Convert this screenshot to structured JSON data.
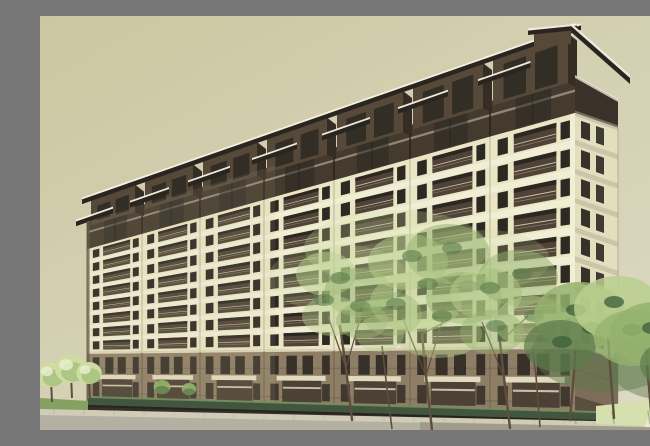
{
  "scene": {
    "type": "architectural-exterior-rendering",
    "subject": "mid-rise residential apartment building viewed in corner perspective with landscaping",
    "building": {
      "balcony_floors": 8,
      "facade_modules": 7,
      "penthouse_caps": 7,
      "podium_levels": 2
    },
    "vegetation": {
      "small_trees_left": 3,
      "transparent_trees_center": 3,
      "foreground_saplings": 2,
      "trees_right_cluster": 4
    }
  },
  "palette": {
    "sky_top": "#cbc7a1",
    "sky_bottom": "#ddd9c4",
    "cream": "#eae5c5",
    "slab_light": "#f2eed7",
    "joint": "#b3ae93",
    "corner_light": "#f4f0db",
    "balc_dark": "#4e4336",
    "balc_shadow": "#2a251f",
    "railing": "#d6d0b4",
    "win_dark": "#2c2822",
    "band_dark": "#453a2e",
    "band_rail": "#d9d4be",
    "band_mullion": "#26211b",
    "cap_front": "#57493a",
    "cap_side": "#352d24",
    "cap_roof": "#2b2520",
    "roof_fascia": "#f5f2e5",
    "side_cream": "#e3debe",
    "side_shade": "#3a3129",
    "podium": "#8f7e66",
    "podium_dark": "#4c4134",
    "podium_win": "#38312a",
    "podium_slab": "#e6dfc4",
    "podium_line": "#6b5d49",
    "podium_side": "#7d6d58",
    "hedge": "#42553f",
    "hedge_light": "#74905e",
    "hedge_base": "#241f19",
    "lawn": "#85a060",
    "grass_right": "#d5e0ae",
    "path": "#eae7d6",
    "curb": "#d0ccb8",
    "road": "#b5b1a2",
    "road_shade": "#8e8878",
    "tree_pale": "#cddd9f",
    "tree_light": "#b9cf8e",
    "tree_mid": "#94b26d",
    "tree_dark": "#5c7b4b",
    "tree_deep": "#3e5d39",
    "trunk": "#5d4e3d",
    "edge_shadow": "#5e5745"
  }
}
